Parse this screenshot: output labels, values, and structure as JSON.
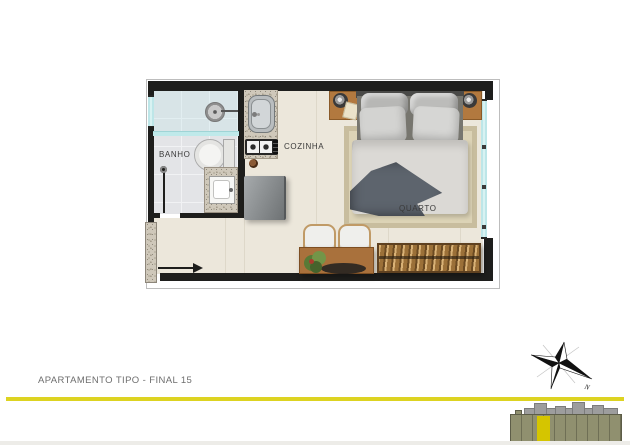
{
  "page": {
    "background": "#ffffff",
    "bottom_strip_color": "#edece8"
  },
  "plan": {
    "wall_color": "#1e1e1c",
    "window_color": "#bde6e8",
    "rooms": [
      {
        "id": "banho",
        "label": "BANHO"
      },
      {
        "id": "cozinha",
        "label": "COZINHA"
      },
      {
        "id": "quarto",
        "label": "QUARTO"
      }
    ],
    "fixtures": [
      "shower-head",
      "glass-partition",
      "toilet",
      "vanity-sink",
      "bathroom-door",
      "kitchen-sink",
      "cooktop",
      "refrigerator",
      "granite-counter",
      "entrance-arrow"
    ],
    "furniture": [
      "double-bed",
      "pillows",
      "duvet",
      "throw-blanket",
      "rug",
      "nightstand",
      "table-lamp",
      "notepad",
      "desk",
      "chairs",
      "plant",
      "slatted-bench"
    ]
  },
  "footer": {
    "title": "APARTAMENTO TIPO - FINAL 15",
    "divider_color": "#ddd321",
    "compass": {
      "north_label": "N"
    },
    "key_plan": {
      "building_color": "#90906f",
      "roof_color": "#9d9d9d",
      "highlight_color": "#d5c500"
    }
  }
}
